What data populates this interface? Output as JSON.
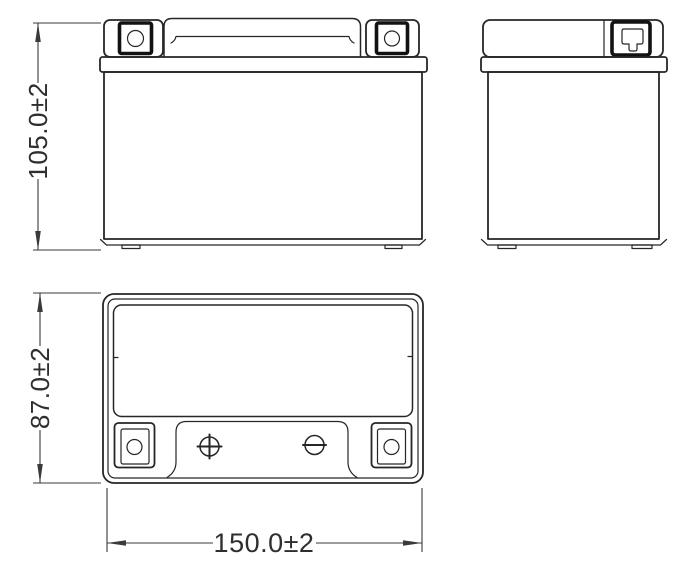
{
  "dimensions": {
    "height": {
      "label": "105.0±2"
    },
    "depth": {
      "label": "87.0±2"
    },
    "width": {
      "label": "150.0±2"
    }
  },
  "icons": {
    "positive_terminal_mark": "+",
    "negative_terminal_mark": "−"
  },
  "colors": {
    "background": "#ffffff",
    "line": "#262626",
    "bold": "#121212",
    "dim": "#3a3a3a",
    "text": "#2e2e2e"
  }
}
